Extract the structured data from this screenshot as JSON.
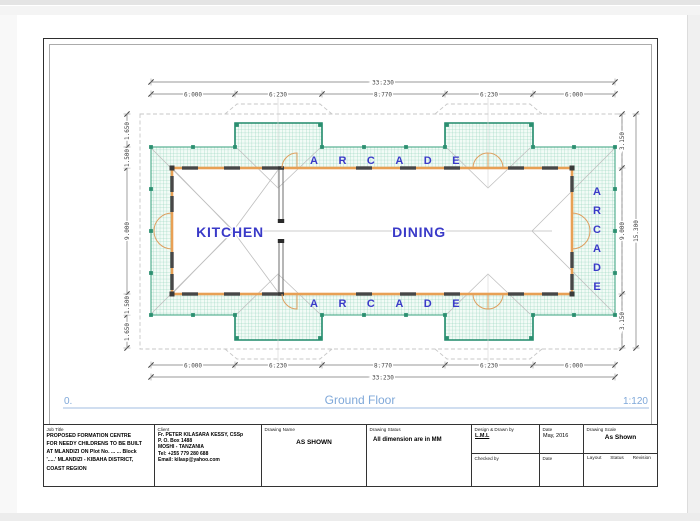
{
  "view": {
    "number": "0.",
    "title": "Ground Floor",
    "scale": "1:120"
  },
  "plan": {
    "kitchen_label": "KITCHEN",
    "dining_label": "DINING",
    "arcade_label": "ARCADE",
    "arcade_letters": [
      "A",
      "R",
      "C",
      "A",
      "D",
      "E"
    ]
  },
  "dimensions": {
    "overall_width": "33.230",
    "h_segments": [
      "6.000",
      "6.230",
      "8.770",
      "6.230",
      "6.000"
    ],
    "left_segments": [
      "1.650",
      "1.500",
      "9.000",
      "1.500",
      "1.650"
    ],
    "right_segments": [
      "3.150",
      "9.000",
      "3.150"
    ],
    "overall_height": "15.300"
  },
  "title_block": {
    "job_title": {
      "label": "Job Title",
      "lines": [
        "PROPOSED FORMATION CENTRE",
        "FOR NEEDY CHILDRENS TO BE BUILT",
        "AT MLANDIZI ON Plot No. ... ... Block",
        "'.....' MLANDIZI - KIBAHA DISTRICT,",
        "COAST REGION"
      ]
    },
    "client": {
      "label": "Client",
      "lines": [
        "Fr. PETER KILASARA KESSY, CSSp",
        "P. O. Box 1488",
        "MOSHI - TANZANIA",
        "Tel: +255 779 280 688",
        "Email: kilasp@yahoo.com"
      ]
    },
    "drawing_name": {
      "label": "Drawing Name",
      "value": "AS SHOWN"
    },
    "drawing_status": {
      "label": "Drawing Status",
      "value": "All dimension are in MM"
    },
    "designed_by": {
      "label": "Design & Drawn by",
      "value": "L.M.L"
    },
    "checked_by": {
      "label": "Checked by"
    },
    "date_drawn": {
      "label": "Date",
      "value": "May, 2016"
    },
    "date_checked": {
      "label": "Date"
    },
    "drawing_scale": {
      "label": "Drawing Scale",
      "value": "As Shown"
    },
    "footer": {
      "layout": "Layout",
      "status": "Status",
      "revision": "Revision"
    }
  },
  "colors": {
    "room_label_blue": "#3a3ac8",
    "wall_orange": "#e8a055",
    "arcade_green": "#2f9b77",
    "view_title_blue": "#7fa8d9"
  }
}
